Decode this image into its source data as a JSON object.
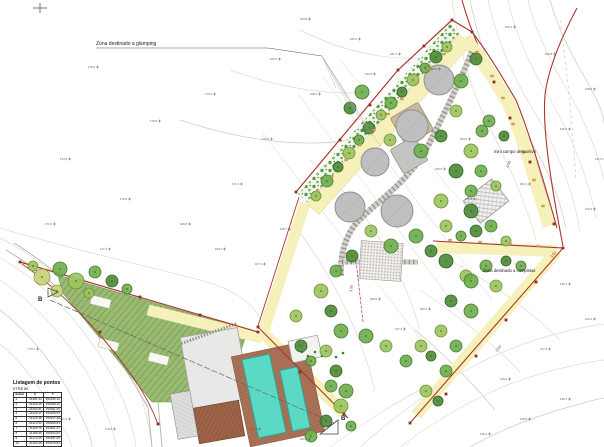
{
  "drawing": {
    "labels": {
      "glamping": "Zona destinado a glamping",
      "sports": "mini campo desportivo",
      "campers": "Zona destinado a campistas",
      "width_300": "3.00",
      "width_350": "3.50",
      "section_b": "B",
      "section_b_prime": "B'"
    },
    "points_table": {
      "title": "Listagem de pontos",
      "subtitle": "ETRS 89",
      "headers": [
        "Índice",
        "X",
        "Y"
      ],
      "rows": [
        [
          "1",
          "-41281.34",
          "153246.12"
        ],
        [
          "2",
          "-41269.45",
          "153238.20"
        ],
        [
          "3",
          "-41254.81",
          "153231.66"
        ],
        [
          "4",
          "-41240.17",
          "153224.93"
        ],
        [
          "5",
          "-41226.38",
          "153217.48"
        ],
        [
          "6",
          "-41213.52",
          "153209.81"
        ],
        [
          "7",
          "-41199.76",
          "153201.37"
        ],
        [
          "8",
          "-41186.90",
          "153194.62"
        ],
        [
          "9",
          "-41173.25",
          "153187.05"
        ],
        [
          "10",
          "-41160.48",
          "153179.84"
        ]
      ]
    },
    "colors": {
      "boundary": "#a8382e",
      "path_fill": "#f6f0bb",
      "field_fill": "#9aba72",
      "field_hatch": "#5f8f43",
      "pool": "#5cd9c4",
      "deck": "#ab7257",
      "platform": "#bfbfbf",
      "tree_palette": [
        "#4e8c3a",
        "#6fae4e",
        "#9cc45f",
        "#c6d37a"
      ]
    },
    "trees": [
      [
        42,
        277,
        8,
        3
      ],
      [
        60,
        269,
        7,
        1
      ],
      [
        76,
        281,
        8,
        2
      ],
      [
        95,
        272,
        6,
        1
      ],
      [
        112,
        281,
        6,
        0
      ],
      [
        57,
        291,
        6,
        3
      ],
      [
        89,
        293,
        5,
        2
      ],
      [
        127,
        289,
        5,
        1
      ],
      [
        33,
        266,
        5,
        2
      ],
      [
        316,
        196,
        5,
        2
      ],
      [
        327,
        181,
        6,
        1
      ],
      [
        338,
        167,
        5,
        0
      ],
      [
        349,
        153,
        6,
        2
      ],
      [
        359,
        140,
        5,
        1
      ],
      [
        369,
        128,
        6,
        0
      ],
      [
        381,
        115,
        5,
        2
      ],
      [
        391,
        103,
        6,
        1
      ],
      [
        402,
        92,
        5,
        0
      ],
      [
        413,
        80,
        6,
        2
      ],
      [
        425,
        68,
        5,
        1
      ],
      [
        436,
        57,
        6,
        0
      ],
      [
        447,
        47,
        5,
        2
      ],
      [
        362,
        92,
        7,
        1
      ],
      [
        350,
        108,
        6,
        0
      ],
      [
        390,
        140,
        6,
        2
      ],
      [
        421,
        151,
        7,
        1
      ],
      [
        441,
        136,
        6,
        0
      ],
      [
        456,
        111,
        6,
        2
      ],
      [
        461,
        81,
        7,
        1
      ],
      [
        476,
        59,
        6,
        0
      ],
      [
        471,
        151,
        7,
        2
      ],
      [
        482,
        131,
        6,
        1
      ],
      [
        456,
        171,
        7,
        0
      ],
      [
        471,
        191,
        6,
        1
      ],
      [
        441,
        201,
        7,
        2
      ],
      [
        416,
        236,
        7,
        1
      ],
      [
        431,
        251,
        6,
        0
      ],
      [
        371,
        231,
        6,
        2
      ],
      [
        391,
        246,
        7,
        1
      ],
      [
        352,
        256,
        6,
        0
      ],
      [
        336,
        271,
        6,
        1
      ],
      [
        321,
        291,
        7,
        2
      ],
      [
        331,
        311,
        6,
        0
      ],
      [
        341,
        331,
        7,
        1
      ],
      [
        326,
        351,
        6,
        2
      ],
      [
        336,
        371,
        6,
        0
      ],
      [
        346,
        391,
        7,
        1
      ],
      [
        489,
        121,
        6,
        1
      ],
      [
        504,
        136,
        5,
        0
      ],
      [
        481,
        171,
        6,
        1
      ],
      [
        496,
        186,
        5,
        2
      ],
      [
        471,
        211,
        7,
        0
      ],
      [
        491,
        226,
        6,
        1
      ],
      [
        446,
        226,
        6,
        2
      ],
      [
        461,
        236,
        5,
        1
      ],
      [
        476,
        231,
        6,
        0
      ],
      [
        506,
        241,
        5,
        2
      ],
      [
        446,
        261,
        7,
        0
      ],
      [
        466,
        276,
        6,
        2
      ],
      [
        486,
        266,
        6,
        1
      ],
      [
        506,
        261,
        5,
        0
      ],
      [
        521,
        266,
        5,
        1
      ],
      [
        471,
        281,
        7,
        1
      ],
      [
        496,
        286,
        6,
        2
      ],
      [
        451,
        301,
        6,
        0
      ],
      [
        471,
        311,
        7,
        1
      ],
      [
        441,
        331,
        6,
        2
      ],
      [
        456,
        346,
        6,
        1
      ],
      [
        431,
        356,
        5,
        0
      ],
      [
        446,
        371,
        6,
        1
      ],
      [
        426,
        391,
        6,
        2
      ],
      [
        438,
        401,
        5,
        0
      ],
      [
        366,
        336,
        7,
        1
      ],
      [
        386,
        346,
        6,
        2
      ],
      [
        301,
        346,
        6,
        0
      ],
      [
        311,
        361,
        5,
        1
      ],
      [
        406,
        361,
        6,
        1
      ],
      [
        421,
        346,
        6,
        2
      ],
      [
        331,
        386,
        6,
        1
      ],
      [
        341,
        406,
        7,
        2
      ],
      [
        326,
        421,
        6,
        0
      ],
      [
        311,
        436,
        6,
        1
      ],
      [
        351,
        426,
        5,
        1
      ],
      [
        296,
        316,
        6,
        2
      ]
    ],
    "platforms": {
      "circles": [
        [
          439,
          80,
          15
        ],
        [
          412,
          126,
          16
        ],
        [
          375,
          162,
          14
        ],
        [
          350,
          207,
          15
        ],
        [
          397,
          211,
          16
        ]
      ],
      "squares": [
        {
          "x": 412,
          "y": 124,
          "s": 32,
          "rot": -30,
          "f": "#cbb99c"
        },
        {
          "x": 409,
          "y": 155,
          "s": 28,
          "rot": -30,
          "f": "#c4c4c2"
        }
      ]
    },
    "spot_elevations": [
      [
        88,
        68,
        "178.2"
      ],
      [
        150,
        122,
        "176.8"
      ],
      [
        205,
        95,
        "175.4"
      ],
      [
        262,
        140,
        "172.6"
      ],
      [
        232,
        185,
        "171.3"
      ],
      [
        180,
        225,
        "169.8"
      ],
      [
        120,
        200,
        "170.2"
      ],
      [
        60,
        160,
        "173.5"
      ],
      [
        310,
        95,
        "168.4"
      ],
      [
        270,
        60,
        "166.9"
      ],
      [
        350,
        40,
        "165.2"
      ],
      [
        300,
        20,
        "163.8"
      ],
      [
        505,
        28,
        "152.4"
      ],
      [
        545,
        55,
        "150.8"
      ],
      [
        585,
        90,
        "148.6"
      ],
      [
        560,
        130,
        "149.2"
      ],
      [
        595,
        160,
        "147.5"
      ],
      [
        520,
        185,
        "151.6"
      ],
      [
        585,
        210,
        "146.9"
      ],
      [
        560,
        285,
        "148.3"
      ],
      [
        585,
        320,
        "146.2"
      ],
      [
        540,
        350,
        "147.8"
      ],
      [
        500,
        380,
        "149.4"
      ],
      [
        560,
        400,
        "145.7"
      ],
      [
        520,
        420,
        "146.8"
      ],
      [
        480,
        435,
        "148.1"
      ],
      [
        370,
        300,
        "158.6"
      ],
      [
        420,
        310,
        "156.2"
      ],
      [
        395,
        330,
        "157.4"
      ],
      [
        280,
        230,
        "168.7"
      ],
      [
        255,
        265,
        "167.3"
      ],
      [
        215,
        250,
        "169.1"
      ],
      [
        100,
        250,
        "172.4"
      ],
      [
        45,
        225,
        "174.6"
      ],
      [
        28,
        350,
        "175.1"
      ],
      [
        60,
        420,
        "177.3"
      ],
      [
        105,
        430,
        "176.5"
      ],
      [
        250,
        430,
        "163.4"
      ],
      [
        300,
        440,
        "161.2"
      ],
      [
        460,
        140,
        "154.3"
      ],
      [
        435,
        170,
        "155.6"
      ],
      [
        465,
        200,
        "153.8"
      ],
      [
        430,
        70,
        "158.9"
      ],
      [
        390,
        55,
        "161.7"
      ],
      [
        365,
        75,
        "162.8"
      ]
    ]
  }
}
